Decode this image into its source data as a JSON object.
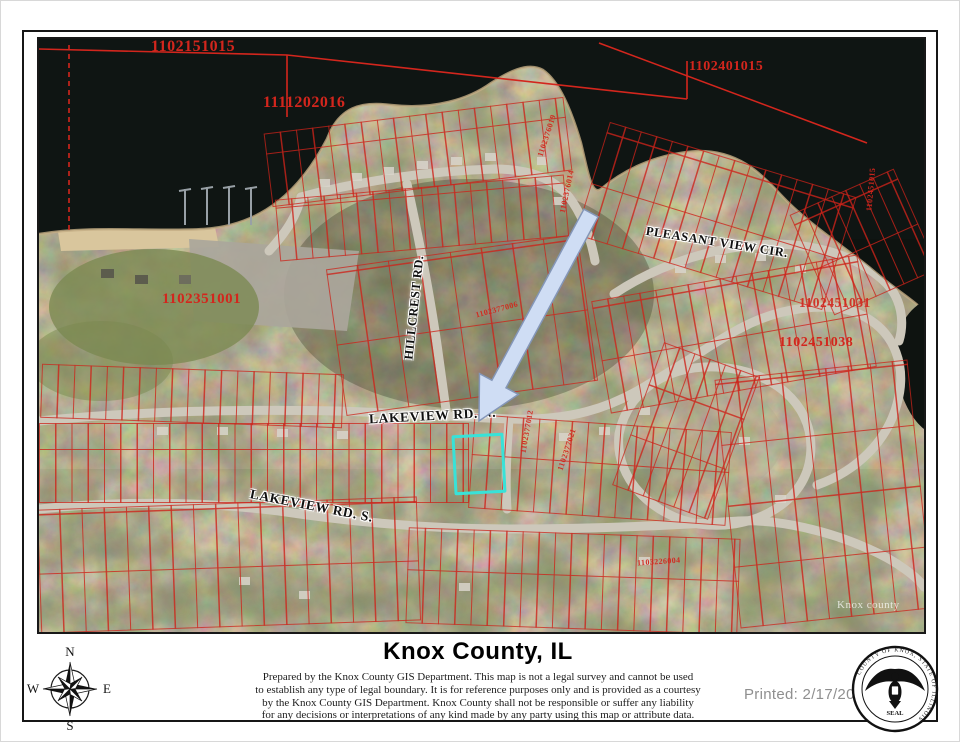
{
  "map": {
    "parcel_labels": [
      "1102151015",
      "1102401015",
      "1111202016",
      "1102351001",
      "1102451031",
      "1102451038"
    ],
    "small_parcel_labels": [
      "1102376019",
      "1102376014",
      "1102377006",
      "1102377012",
      "1102377021",
      "1103226004",
      "1102451015"
    ],
    "road_labels": {
      "pleasant_view": "PLEASANT VIEW CIR.",
      "hillcrest": "HILLCREST RD.",
      "lakeview_n": "LAKEVIEW RD. N.",
      "lakeview_s": "LAKEVIEW RD. S."
    },
    "watermark": "Knox county"
  },
  "compass": {
    "n": "N",
    "s": "S",
    "e": "E",
    "w": "W"
  },
  "seal": {
    "ring_text": "COUNTY OF KNOX, STATE OF ILLINOIS",
    "seal_word": "SEAL"
  },
  "footer": {
    "title": "Knox County, IL",
    "disclaimer_lines": [
      "Prepared by the Knox County GIS Department. This map is not a legal survey and cannot be used",
      "to establish any type of legal boundary. It is for reference purposes only and is provided as a courtesy",
      "by the Knox County GIS Department.  Knox County shall not be responsible or suffer any liability",
      "for any decisions or interpretations of any kind made by any party using this map or attribute data."
    ],
    "printed": "Printed: 2/17/2026"
  },
  "colors": {
    "parcel_line_red": "#d3261d",
    "highlight_cyan": "#38e2d8",
    "arrow_blue": "#cfddf4",
    "water_dark": "#0e1310",
    "land_tan": "#8a7a60",
    "road_gray": "#cdc8bb",
    "printed_gray": "#8f8f8f"
  }
}
